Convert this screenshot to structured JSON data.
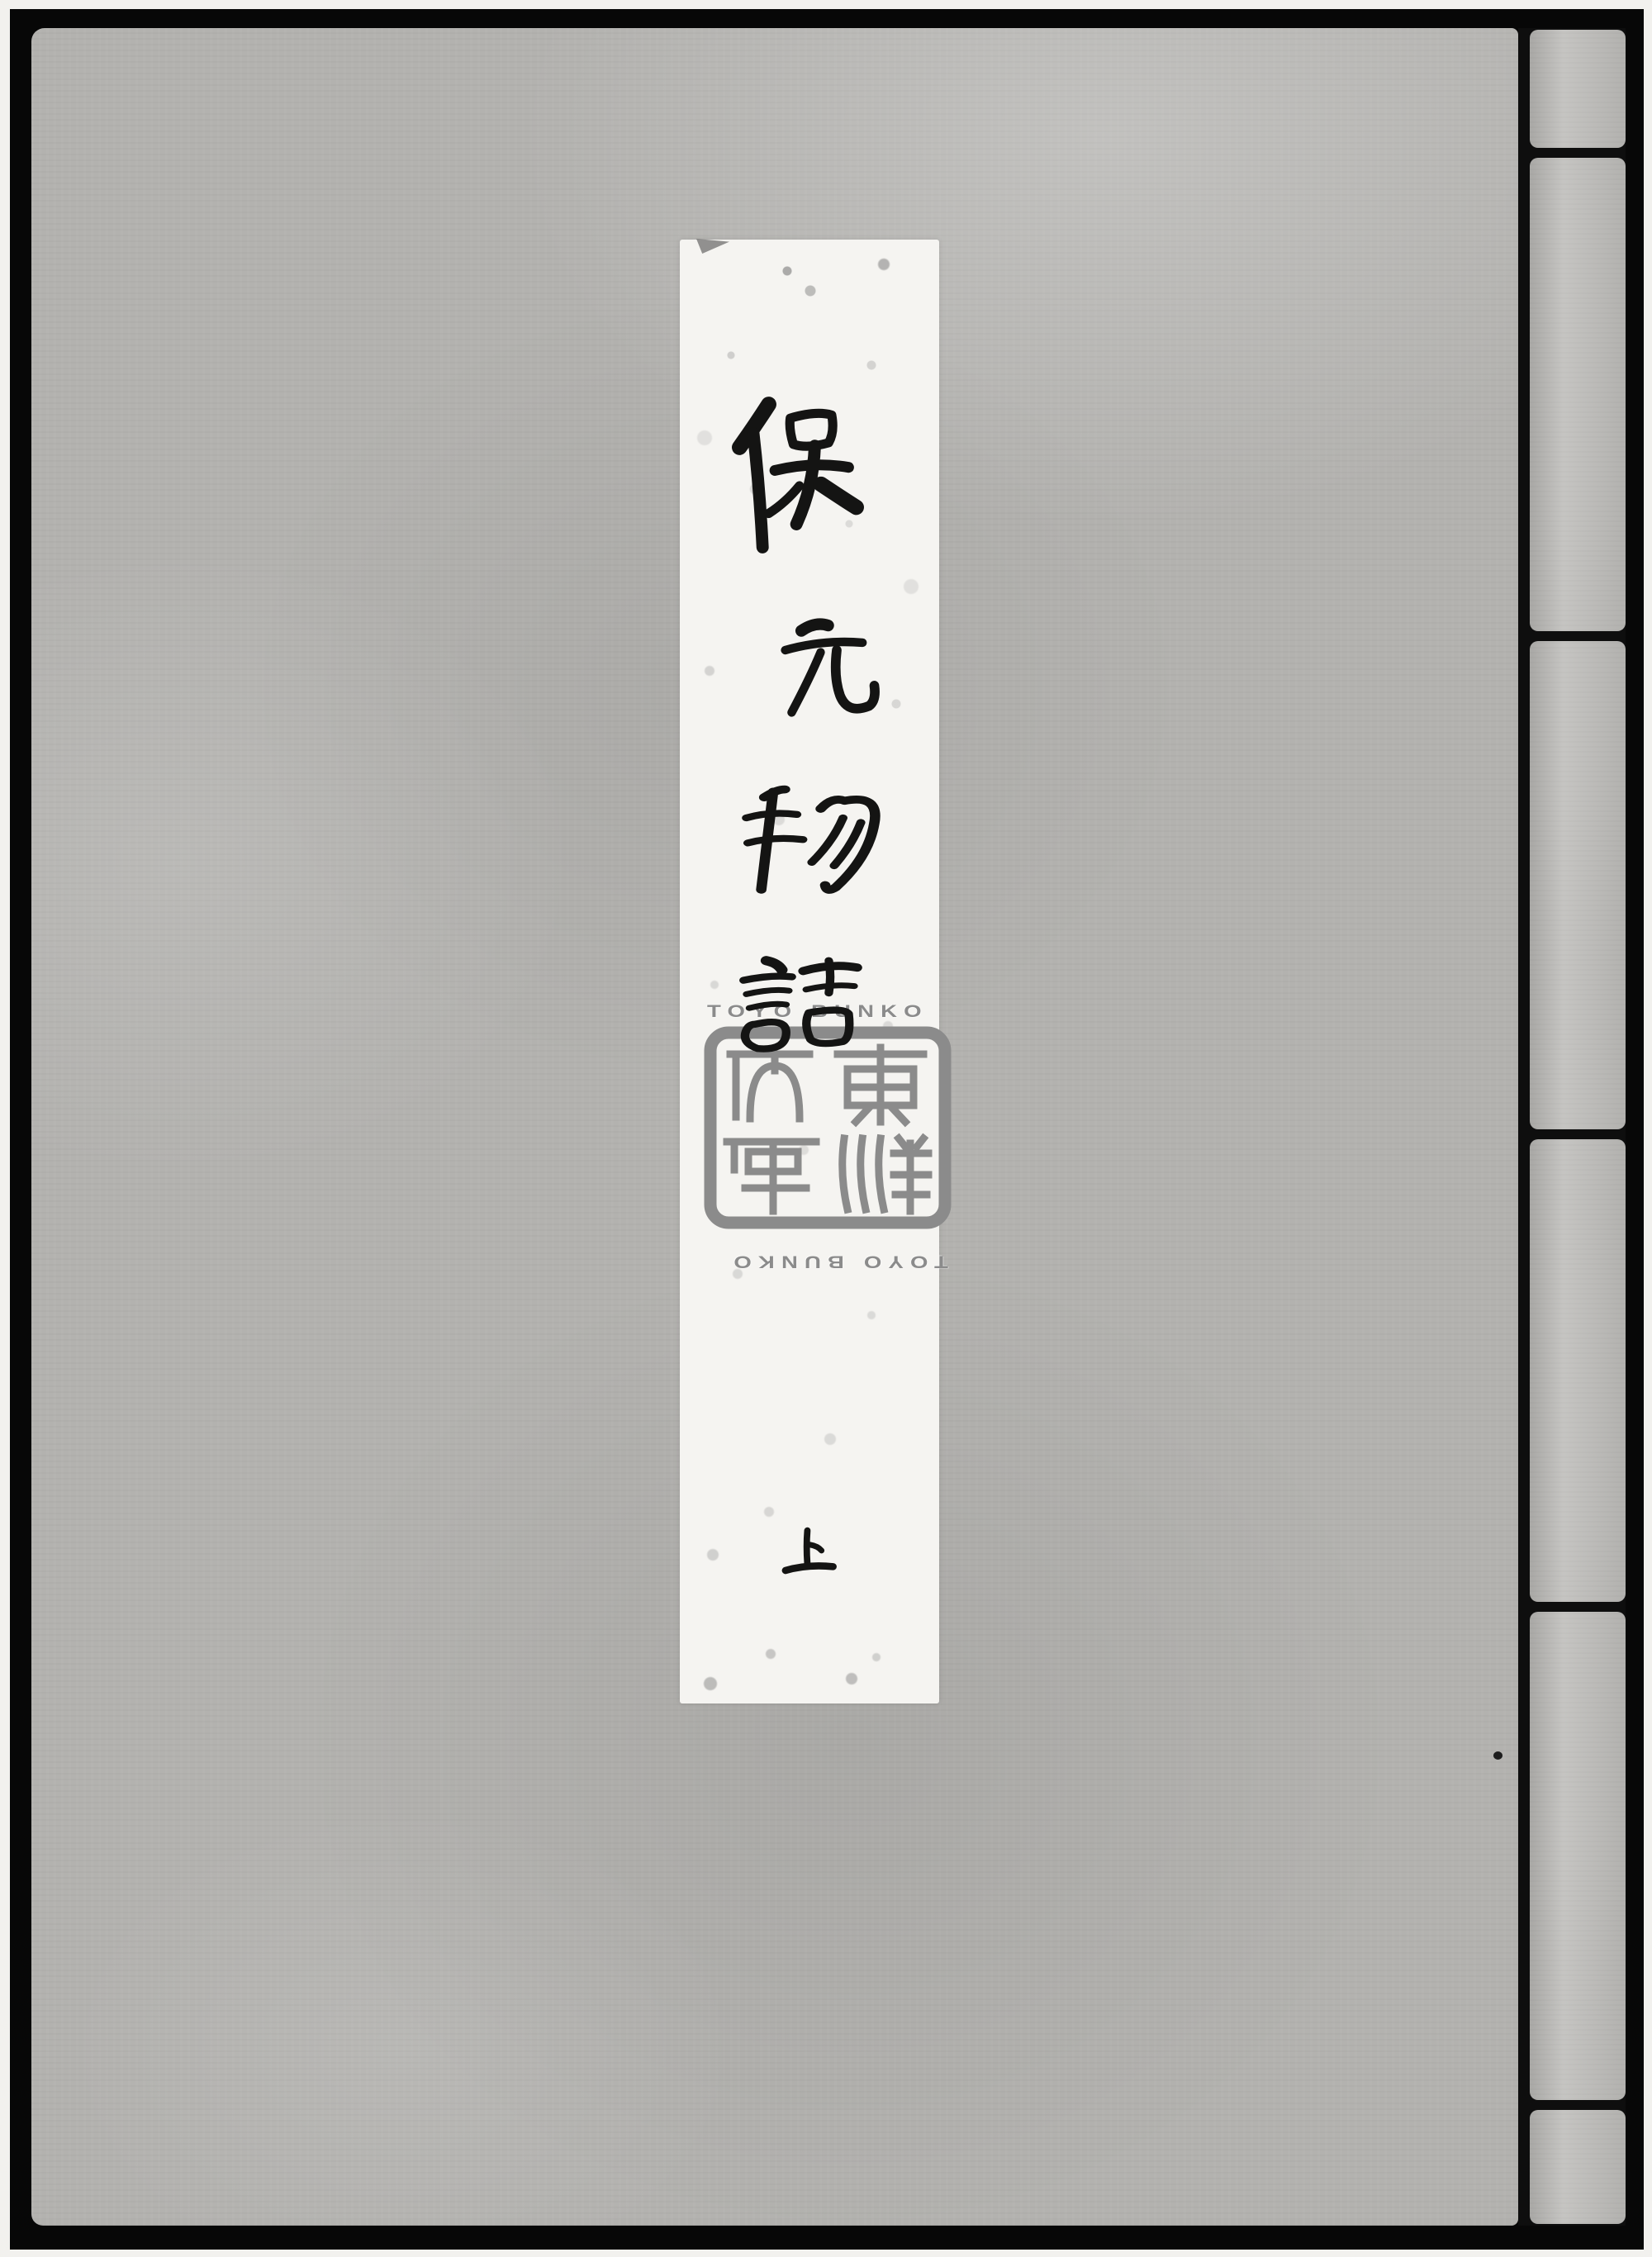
{
  "page": {
    "alt": "Scanned grey cloth cover of a traditional Japanese stitch-bound book with a white vertical title slip"
  },
  "cover": {
    "title_label": {
      "title": "保元物語",
      "characters": [
        "保",
        "元",
        "物",
        "語"
      ],
      "volume": "上"
    },
    "binding": {
      "segments": 6
    }
  },
  "watermark": {
    "top_text": "TOYO BUNKO",
    "bottom_text": "TOYO BUNKO",
    "seal_text": "東洋文庫"
  },
  "colors": {
    "cover_grey": "#b3b2af",
    "binding_grey": "#bcbbb8",
    "label_white": "#f5f4f1",
    "ink_black": "#141413",
    "watermark_grey": "#8b8b8b",
    "frame_black": "#070707"
  }
}
